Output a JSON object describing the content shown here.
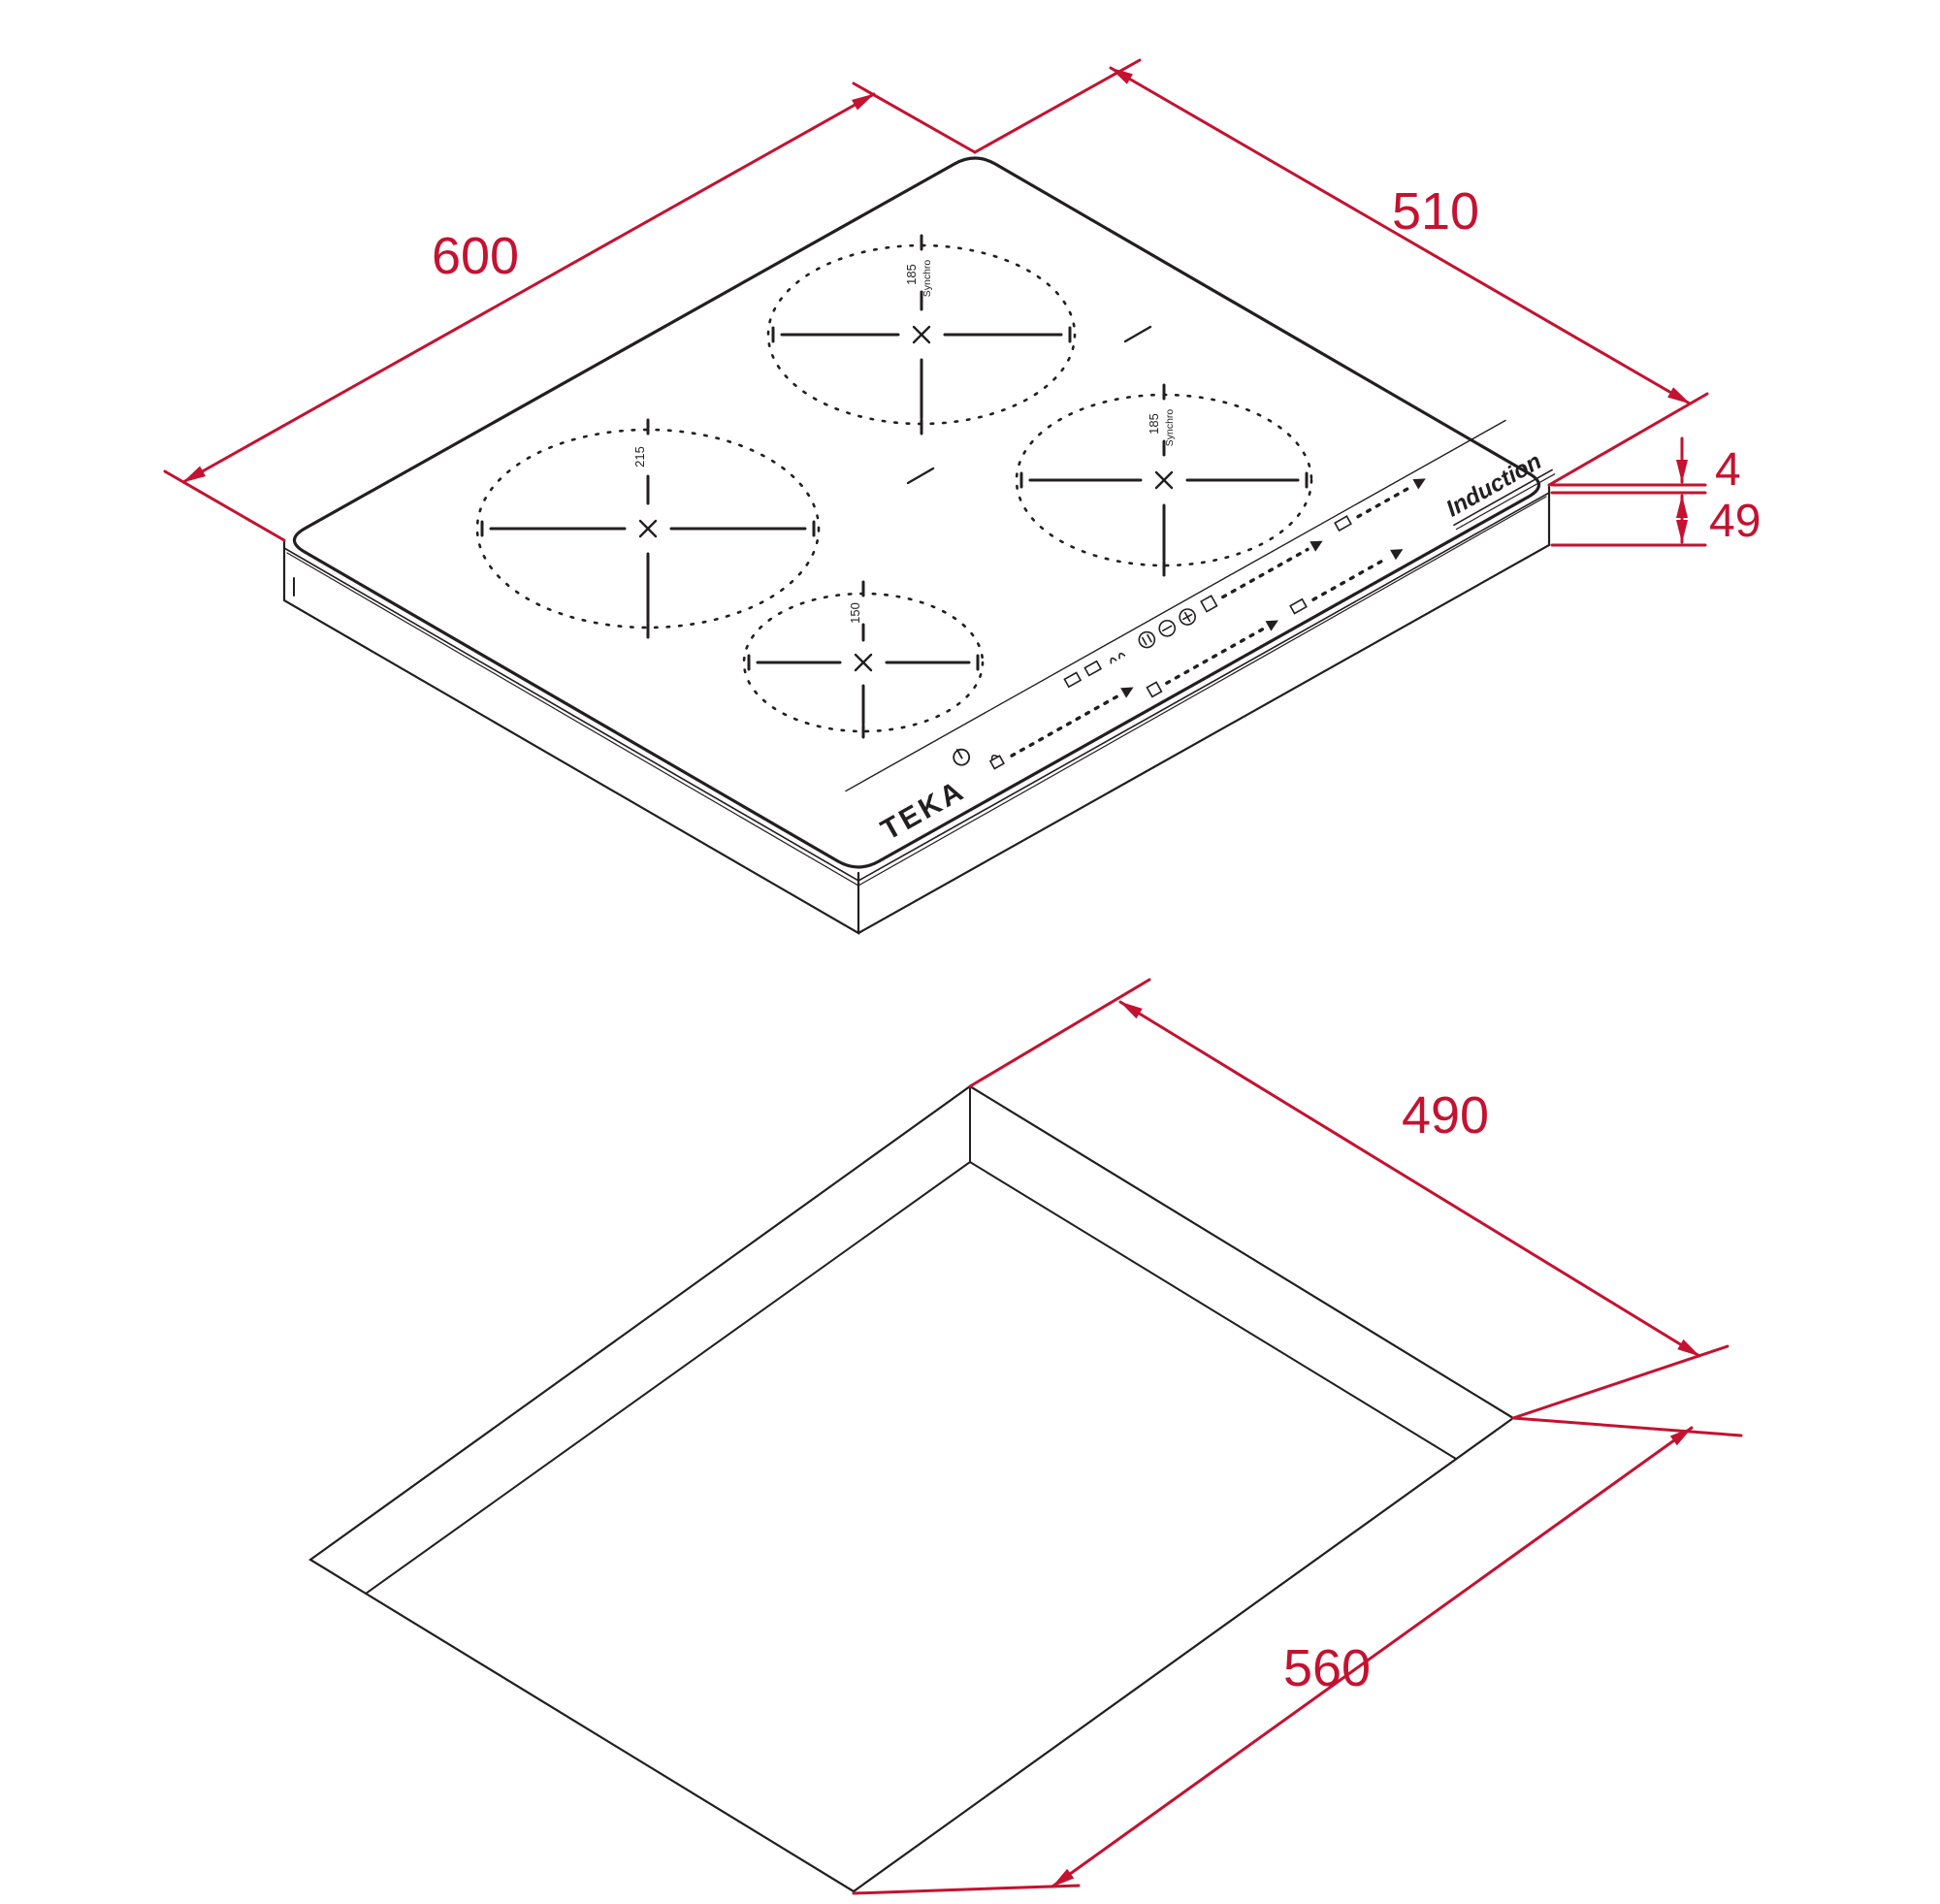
{
  "page": {
    "background": "#ffffff"
  },
  "colors": {
    "dimension_red": "#C41230",
    "drawing_black": "#231F20"
  },
  "top_view": {
    "name": "induction-hob-isometric-view",
    "dims": {
      "width": "600",
      "depth": "510",
      "glass_thickness": "4",
      "body_height": "49"
    },
    "brand": "TEKA",
    "technology": "Induction",
    "zones": {
      "left": {
        "label": "215"
      },
      "top": {
        "label": "185",
        "sublabel": "Synchro"
      },
      "right": {
        "label": "185",
        "sublabel": "Synchro"
      },
      "bottom": {
        "label": "150"
      }
    },
    "controls": {
      "icons": [
        "power-icon",
        "key-lock-icon",
        "slider-dots",
        "pot-icon",
        "plus-icon",
        "minus-icon",
        "pause-icon",
        "arrow-icon"
      ]
    }
  },
  "cutout_view": {
    "name": "worktop-cutout-isometric-view",
    "dims": {
      "depth": "490",
      "width": "560"
    }
  }
}
